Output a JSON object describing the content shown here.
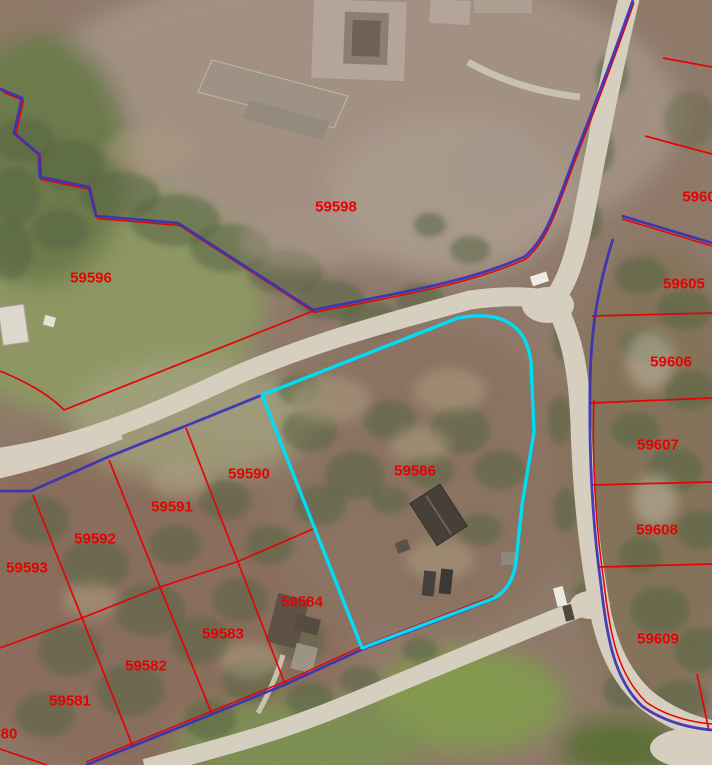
{
  "map": {
    "type": "parcel-gis-aerial-view",
    "selected_parcel": "59586",
    "colors": {
      "parcel_line": "#e30505",
      "subdivision_boundary": "#3c31b4",
      "selected_outline": "#00dcf5",
      "label_color": "#e60000"
    },
    "labels": [
      {
        "id": "59598",
        "text": "59598",
        "x": 336,
        "y": 207
      },
      {
        "id": "59596",
        "text": "59596",
        "x": 91,
        "y": 278
      },
      {
        "id": "5960x",
        "text": "5960",
        "x": 699,
        "y": 197
      },
      {
        "id": "59605",
        "text": "59605",
        "x": 684,
        "y": 284
      },
      {
        "id": "59606",
        "text": "59606",
        "x": 671,
        "y": 362
      },
      {
        "id": "59607",
        "text": "59607",
        "x": 658,
        "y": 445
      },
      {
        "id": "59608",
        "text": "59608",
        "x": 657,
        "y": 530
      },
      {
        "id": "59609",
        "text": "59609",
        "x": 658,
        "y": 639
      },
      {
        "id": "59586",
        "text": "59586",
        "x": 415,
        "y": 471,
        "selected": true
      },
      {
        "id": "59590",
        "text": "59590",
        "x": 249,
        "y": 474
      },
      {
        "id": "59591",
        "text": "59591",
        "x": 172,
        "y": 507
      },
      {
        "id": "59592",
        "text": "59592",
        "x": 95,
        "y": 539
      },
      {
        "id": "59593",
        "text": "59593",
        "x": 27,
        "y": 568
      },
      {
        "id": "59584",
        "text": "59584",
        "x": 302,
        "y": 602
      },
      {
        "id": "59583",
        "text": "59583",
        "x": 223,
        "y": 634
      },
      {
        "id": "59582",
        "text": "59582",
        "x": 146,
        "y": 666
      },
      {
        "id": "59581",
        "text": "59581",
        "x": 70,
        "y": 701
      },
      {
        "id": "59580",
        "text": "80",
        "x": 9,
        "y": 734
      }
    ]
  }
}
